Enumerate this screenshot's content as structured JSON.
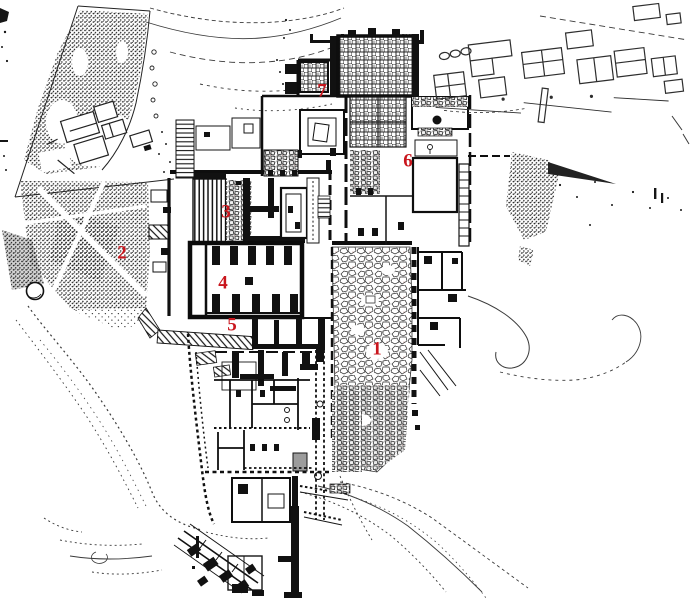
{
  "map": {
    "colors": {
      "background": "#ffffff",
      "ink": "#111111",
      "label": "#c9161d"
    },
    "labels": [
      {
        "text": "1",
        "x": 377,
        "y": 350
      },
      {
        "text": "2",
        "x": 122,
        "y": 254
      },
      {
        "text": "3",
        "x": 226,
        "y": 213
      },
      {
        "text": "4",
        "x": 223,
        "y": 284
      },
      {
        "text": "5",
        "x": 232,
        "y": 326
      },
      {
        "text": "6",
        "x": 408,
        "y": 162
      },
      {
        "text": "7",
        "x": 322,
        "y": 92
      }
    ]
  }
}
